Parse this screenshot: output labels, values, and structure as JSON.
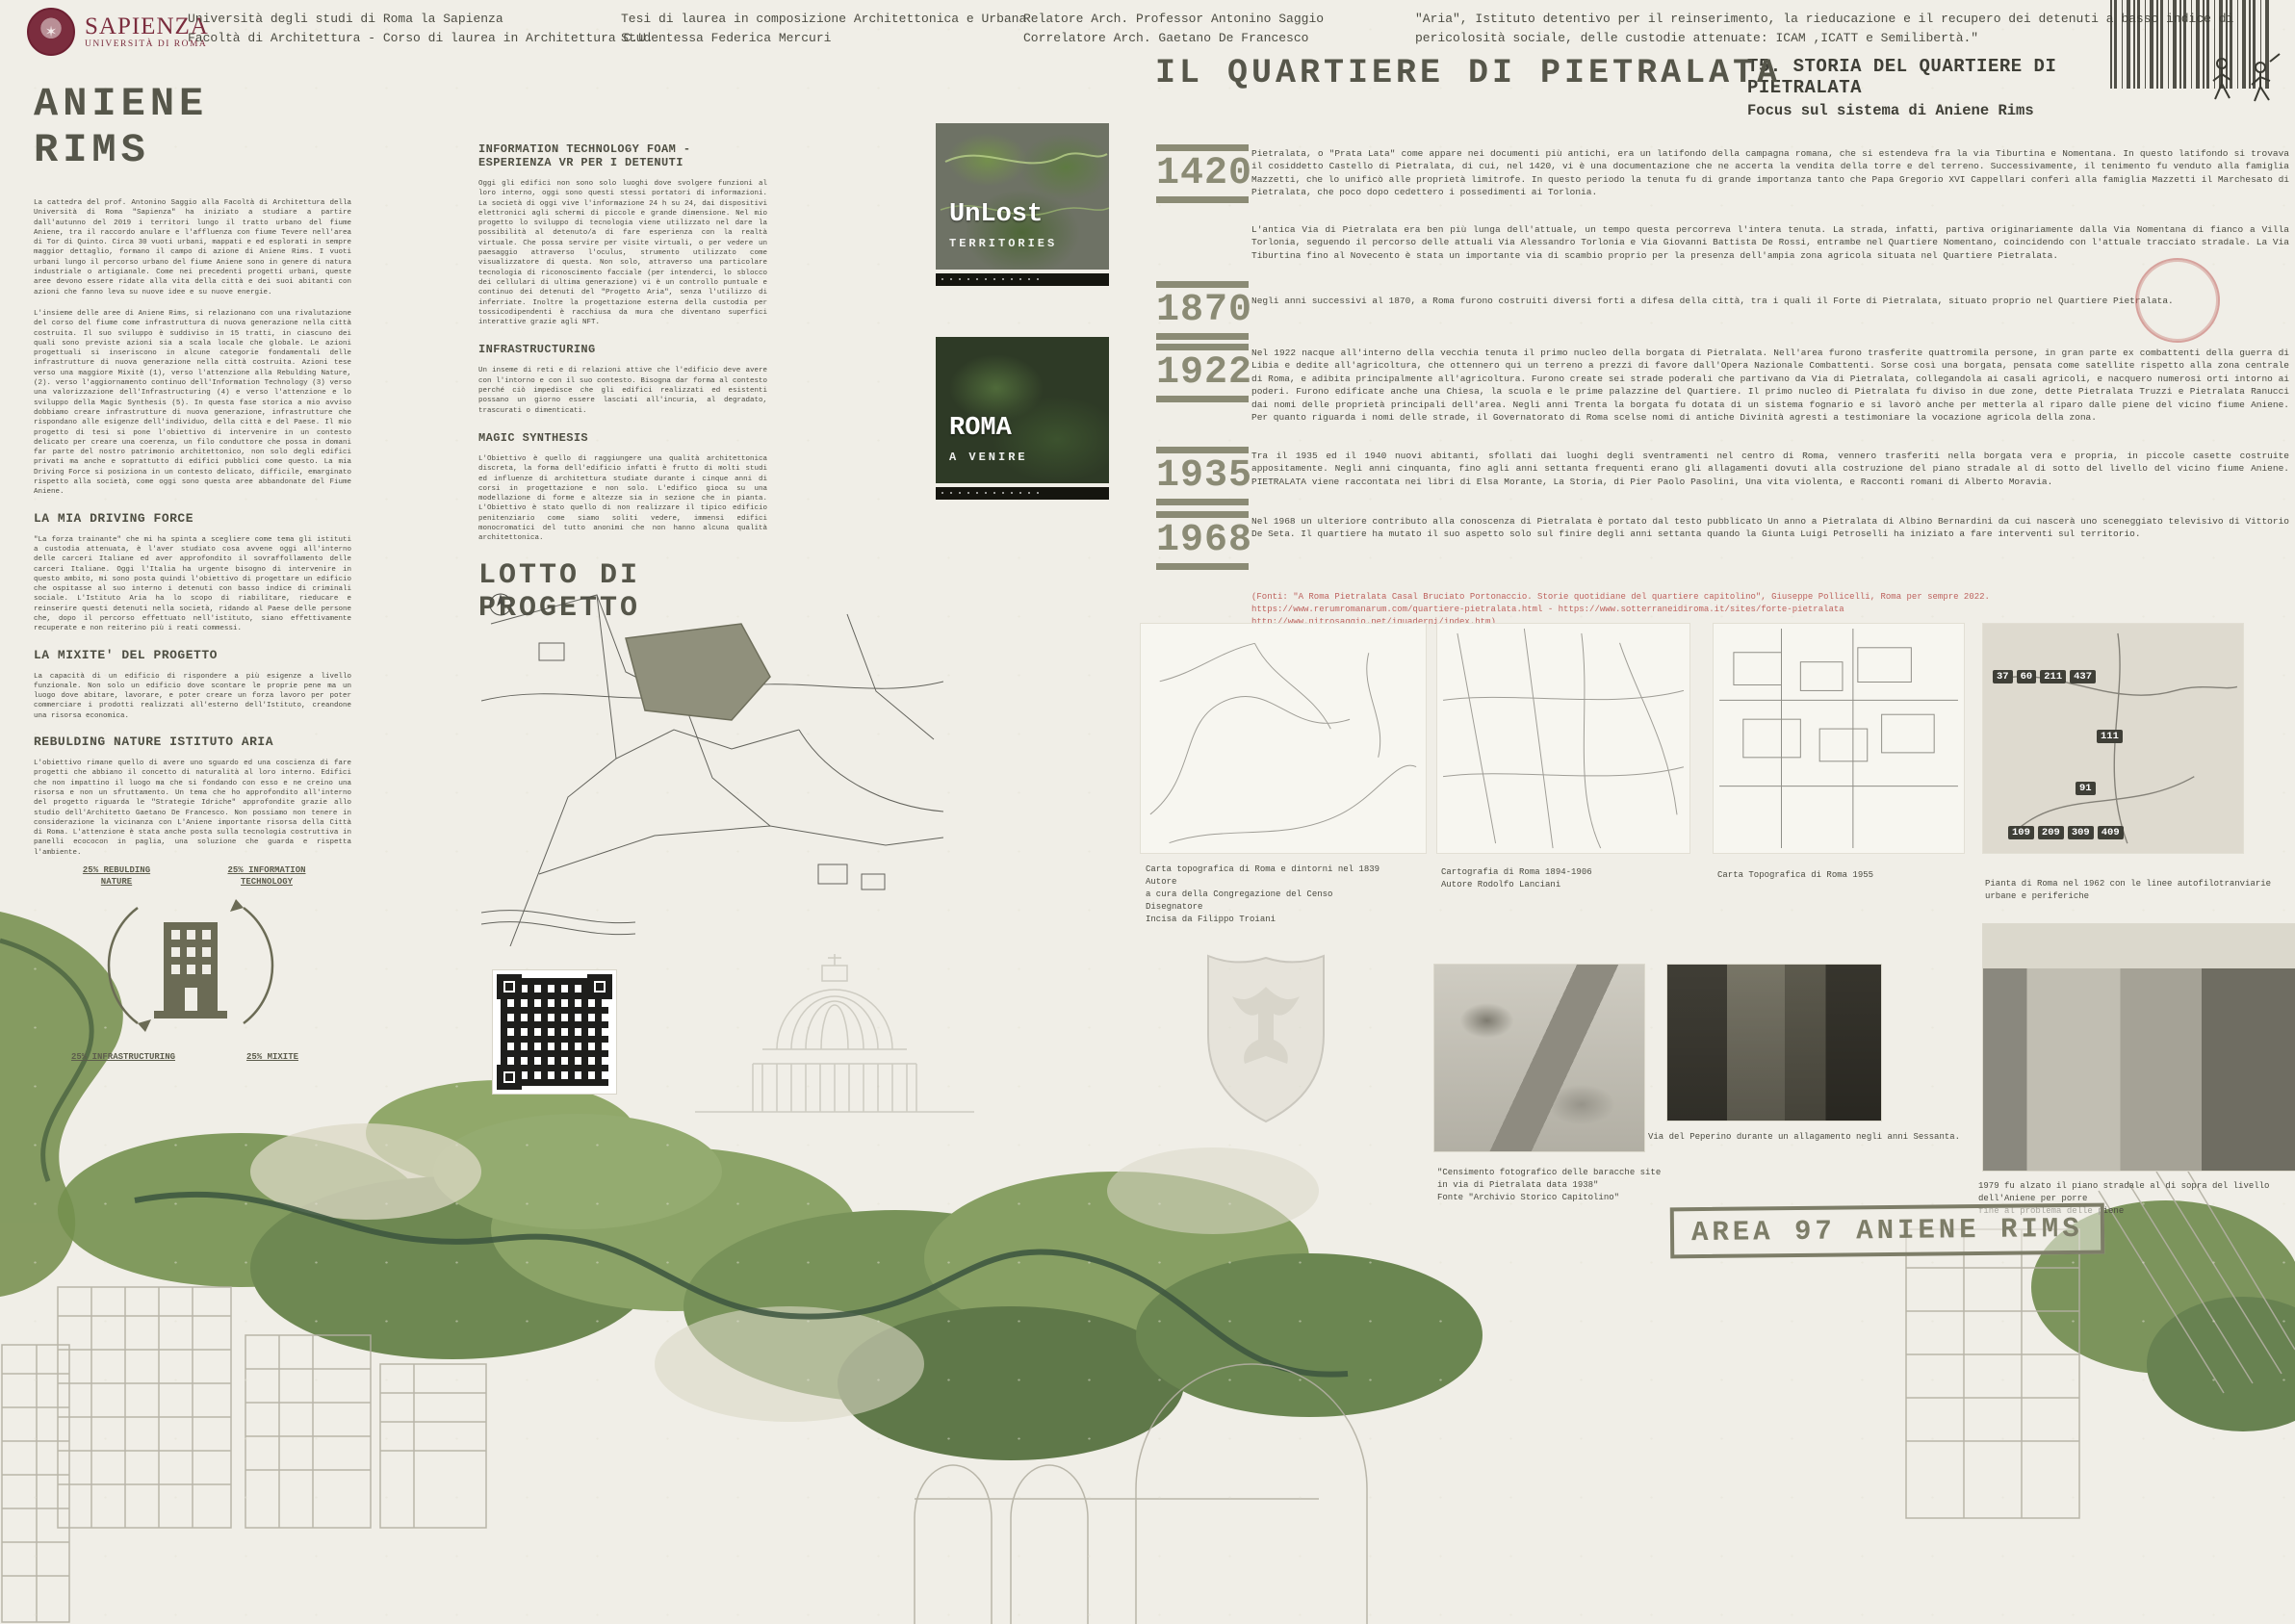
{
  "header": {
    "logo": {
      "brand": "SAPIENZA",
      "subtitle": "UNIVERSITÀ DI ROMA"
    },
    "university_line1": "Università degli studi di Roma la Sapienza",
    "university_line2": "Facoltà di Architettura - Corso di laurea in Architettura C.U.",
    "thesis_line1": "Tesi di laurea in composizione Architettonica e Urbana",
    "thesis_line2": "Studentessa Federica Mercuri",
    "advisor_line1": "Relatore Arch. Professor Antonino Saggio",
    "advisor_line2": "Correlatore Arch. Gaetano De Francesco",
    "aria_quote_line1": "\"Aria\",  Istituto detentivo per il reinserimento, la rieducazione  e il recupero dei detenuti a basso indice di",
    "aria_quote_line2": "pericolosità sociale, delle custodie attenuate: ICAM ,ICATT e Semilibertà.\"",
    "board_title": "T5. STORIA DEL QUARTIERE DI PIETRALATA",
    "board_subtitle": "Focus sul sistema di Aniene Rims"
  },
  "left": {
    "title": "ANIENE RIMS",
    "intro1": "La cattedra del prof. Antonino Saggio alla Facoltà di Architettura della Università di Roma \"Sapienza\" ha iniziato a studiare a partire dall'autunno del 2019 i territori lungo il tratto urbano del fiume Aniene, tra il raccordo anulare e l'affluenza con fiume Tevere nell'area di Tor di Quinto. Circa 30 vuoti urbani, mappati e ed esplorati in sempre maggior dettaglio, formano il campo di azione di Aniene Rims. I vuoti urbani lungo il percorso urbano del fiume Aniene sono in genere di natura industriale o artigianale. Come nei precedenti progetti urbani, queste aree devono essere ridate alla vita della città e dei suoi abitanti con azioni che fanno leva su nuove idee e su nuove energie.",
    "intro2": "L'insieme delle aree di Aniene Rims, si relazionano con una rivalutazione del corso del fiume come infrastruttura di nuova generazione nella città costruita. Il suo sviluppo è suddiviso in 15 tratti, in ciascuno dei quali sono previste azioni sia a scala locale che globale. Le azioni progettuali si inseriscono in alcune categorie fondamentali delle infrastrutture di nuova generazione nella città costruita. Azioni tese verso una maggiore Mixitè (1), verso l'attenzione alla Rebulding Nature,(2). verso l'aggiornamento continuo dell'Information Technology (3) verso una valorizzazione dell'Infrastructuring (4) e verso l'attenzione e lo sviluppo della Magic Synthesis (5). In questa fase storica a mio avviso dobbiamo creare infrastrutture di nuova generazione, infrastrutture che rispondano alle esigenze dell'individuo, della città e del Paese. Il mio progetto di tesi si pone l'obiettivo di intervenire in un contesto delicato per creare una coerenza, un filo conduttore che possa in domani far parte del nostro patrimonio architettonico, non solo degli edifici privati ma anche e soprattutto di edifici pubblici come questo. La mia Driving Force si posiziona in un contesto delicato, difficile, emarginato rispetto alla società, come oggi sono questa aree abbandonate del Fiume Aniene.",
    "sections": [
      {
        "heading": "LA MIA DRIVING FORCE",
        "body": "\"La forza trainante\" che mi ha spinta a scegliere come tema gli istituti a custodia attenuata, è l'aver studiato cosa avvene oggi all'interno delle carceri Italiane ed aver approfondito il sovraffollamento delle carceri Italiane. Oggi l'Italia ha urgente bisogno di intervenire in questo ambito, mi sono posta quindi l'obiettivo di progettare un edificio che ospitasse al suo interno i detenuti con basso indice di criminali sociale. L'Istituto Aria ha lo scopo di riabilitare, rieducare e reinserire questi detenuti nella società, ridando al Paese delle persone che, dopo il percorso effettuato nell'istituto, siano effettivamente recuperate e non reiterino più i reati commessi."
      },
      {
        "heading": "LA MIXITE' DEL PROGETTO",
        "body": "La capacità di un edificio di rispondere a più esigenze a livello funzionale. Non solo un edificio dove scontare le proprie pene ma un luogo dove abitare, lavorare, e poter creare un forza lavoro per poter commerciare i prodotti realizzati all'esterno dell'Istituto, creandone una risorsa economica."
      },
      {
        "heading": "REBULDING NATURE ISTITUTO ARIA",
        "body": "L'obiettivo rimane quello di avere uno sguardo ed una coscienza di fare progetti che abbiano il concetto di naturalità al loro interno. Edifici che non impattino il luogo ma che si fondando con esso e ne creino una risorsa e non un sfruttamento. Un tema che ho approfondito all'interno del progetto riguarda le \"Strategie Idriche\" approfondite grazie allo studio dell'Architetto Gaetano De Francesco. Non possiamo non tenere in considerazione la vicinanza con L'Aniene importante risorsa della Città di Roma. L'attenzione è stata anche posta sulla tecnologia costruttiva in panelli ecococon in paglia, una soluzione che guarda e rispetta l'ambiente."
      }
    ],
    "diagram": {
      "labels": [
        "25% REBULDING\nNATURE",
        "25% INFORMATION\nTECHNOLOGY",
        "25% INFRASTRUCTURING",
        "25% MIXITE"
      ]
    }
  },
  "middle": {
    "sections": [
      {
        "heading": "INFORMATION TECHNOLOGY FOAM - ESPERIENZA VR PER I DETENUTI",
        "body": "Oggi gli edifici non sono solo luoghi dove svolgere funzioni al loro interno, oggi sono questi stessi portatori di informazioni. La società di oggi vive l'informazione 24 h su 24, dai dispositivi elettronici agli schermi di piccole e grande dimensione. Nel mio progetto lo sviluppo di tecnologia viene utilizzato nel dare la possibilità al detenuto/a di fare esperienza con la realtà virtuale. Che possa servire per visite virtuali, o per vedere un paesaggio attraverso l'oculus, strumento utilizzato come visualizzatore di questa. Non solo, attraverso una particolare tecnologia di riconoscimento facciale (per intenderci, lo sblocco dei cellulari di ultima generazione) vi è un controllo puntuale e continuo dei detenuti del \"Progetto Aria\", senza l'utilizzo di inferriate. Inoltre la progettazione esterna della custodia per tossicodipendenti è racchiusa da mura che diventano superfici interattive grazie agli NFT."
      },
      {
        "heading": "INFRASTRUCTURING",
        "body": "Un inseme di reti e di relazioni attive che l'edificio deve avere con l'intorno e con il suo contesto. Bisogna dar forma al contesto perché ciò impedisce che gli edifici realizzati ed esistenti possano un giorno essere lasciati all'incuria, al degradato, trascurati o dimenticati."
      },
      {
        "heading": "MAGIC SYNTHESIS",
        "body": "L'Obiettivo è quello di raggiungere una qualità architettonica discreta, la forma dell'edificio infatti è frutto di molti studi ed influenze di architettura studiate durante i cinque anni di corsi in progettazione e non solo. L'edifico gioca su una modellazione di forme e altezze sia in sezione che in pianta. L'Obiettivo è stato quello di non realizzare il tipico edificio penitenziario come siamo soliti vedere, immensi edifici monocromatici del tutto anonimi che non hanno alcuna qualità architettonica."
      }
    ],
    "lotto_title": "LOTTO DI PROGETTO"
  },
  "green_cards": [
    {
      "line1": "UnLost",
      "line2": "TERRITORIES"
    },
    {
      "line1": "ROMA",
      "line2": "A VENIRE"
    }
  ],
  "pietralata": {
    "title": "IL QUARTIERE DI PIETRALATA",
    "timeline": [
      {
        "year": "1420",
        "text": "Pietralata, o \"Prata Lata\" come appare nei documenti più antichi, era un latifondo della campagna romana, che si estendeva fra la via Tiburtina e Nomentana. In questo latifondo si trovava il cosiddetto Castello di Pietralata, di cui, nel 1420, vi è una documentazione che ne accerta la vendita della torre e del terreno. Successivamente, il tenimento fu venduto alla famiglia Mazzetti, che lo unificò alle proprietà limitrofe. In questo periodo la tenuta fu di grande importanza tanto che Papa Gregorio XVI Cappellari conferì alla famiglia Mazzetti il Marchesato di Pietralata, che poco dopo cedettero i possedimenti ai Torlonia.",
        "extra": "L'antica Via di Pietralata era ben più lunga dell'attuale, un tempo questa percorreva l'intera tenuta. La strada, infatti, partiva originariamente dalla Via Nomentana di fianco a Villa Torlonia, seguendo il percorso delle attuali Via Alessandro Torlonia e Via Giovanni Battista De Rossi, entrambe nel Quartiere Nomentano, coincidendo con l'attuale tracciato stradale. La Via Tiburtina fino al Novecento è stata un importante via di scambio proprio per la presenza dell'ampia zona agricola situata nel Quartiere Pietralata."
      },
      {
        "year": "1870",
        "text": "Negli anni successivi al 1870, a Roma furono costruiti diversi forti a difesa della città, tra i quali il Forte di Pietralata, situato proprio nel Quartiere Pietralata."
      },
      {
        "year": "1922",
        "text": "Nel 1922 nacque all'interno della vecchia tenuta il primo nucleo della borgata di Pietralata. Nell'area furono trasferite quattromila persone, in gran parte ex combattenti della guerra di Libia e dedite all'agricoltura, che ottennero qui un terreno a prezzi di favore dall'Opera Nazionale Combattenti. Sorse così una borgata, pensata come satellite rispetto alla zona centrale di Roma, e adibita principalmente all'agricoltura. Furono create sei strade poderali che partivano da Via di Pietralata, collegandola ai casali agricoli, e nacquero numerosi orti intorno ai poderi. Furono edificate anche una Chiesa, la scuola e le prime palazzine del Quartiere. Il primo nucleo di Pietralata fu diviso in due zone, dette Pietralata Truzzi e Pietralata Ranucci dai nomi delle proprietà principali dell'area. Negli anni Trenta la borgata fu dotata di un sistema fognario e si lavorò anche per metterla al riparo dalle piene del vicino fiume Aniene. Per quanto riguarda i nomi delle strade, il Governatorato di Roma scelse nomi di antiche Divinità agresti a testimoniare la vocazione agricola della zona."
      },
      {
        "year": "1935",
        "text": "Tra il 1935 ed il 1940 nuovi abitanti, sfollati dai luoghi degli sventramenti nel centro di Roma, vennero trasferiti nella borgata vera e propria, in piccole casette costruite appositamente. Negli anni cinquanta, fino agli anni settanta frequenti erano gli allagamenti dovuti alla costruzione del piano stradale al di sotto del livello del vicino fiume Aniene. PIETRALATA viene raccontata nei libri di Elsa Morante, La Storia, di Pier Paolo Pasolini, Una vita violenta, e Racconti romani di Alberto Moravia."
      },
      {
        "year": "1968",
        "text": "Nel 1968 un ulteriore contributo alla conoscenza di Pietralata è portato dal testo pubblicato Un anno a Pietralata di Albino Bernardini da cui nascerà uno sceneggiato televisivo di Vittorio De Seta. Il quartiere ha mutato il suo aspetto solo sul finire degli anni settanta quando la Giunta Luigi Petroselli ha iniziato a fare interventi sul territorio."
      }
    ],
    "sources": "(Fonti: \"A Roma Pietralata Casal Bruciato Portonaccio. Storie quotidiane del quartiere capitolino\", Giuseppe Pollicelli, Roma per sempre 2022.\nhttps://www.rerumromanarum.com/quartiere-pietralata.html - https://www.sotterraneidiroma.it/sites/forte-pietralata\nhttp://www.nitrosaggio.net/iquaderni/index.htm)"
  },
  "maps_row": [
    {
      "caption": "Carta topografica di Roma e dintorni nel 1839\nAutore\na cura della Congregazione del Censo\nDisegnatore\nIncisa da Filippo Troiani"
    },
    {
      "caption": "Cartografia di Roma 1894-1906\nAutore Rodolfo Lanciani"
    },
    {
      "caption": "Carta Topografica di Roma 1955"
    },
    {
      "caption": "Pianta di Roma nel 1962 con le linee autofilotranviarie\nurbane e periferiche",
      "route_badges": [
        "37",
        "60",
        "211",
        "437",
        "111",
        "91",
        "109",
        "209",
        "309",
        "409"
      ]
    }
  ],
  "photos_row": [
    {
      "caption": "\"Censimento fotografico delle baracche site\nin via di Pietralata data 1938\"\nFonte \"Archivio Storico Capitolino\""
    },
    {
      "caption": "Via del Peperino durante un allagamento negli anni Sessanta."
    },
    {
      "caption": "1979 fu alzato il piano stradale al di sopra del livello dell'Aniene per porre\nfine al problema delle piene"
    }
  ],
  "area_stamp": "AREA 97 ANIENE RIMS",
  "colors": {
    "accent_olive": "#56564a",
    "stamp_olive": "#8b8b75",
    "source_red": "#bd625e",
    "maroon": "#7b2d3e",
    "paper": "#f0eee7"
  }
}
